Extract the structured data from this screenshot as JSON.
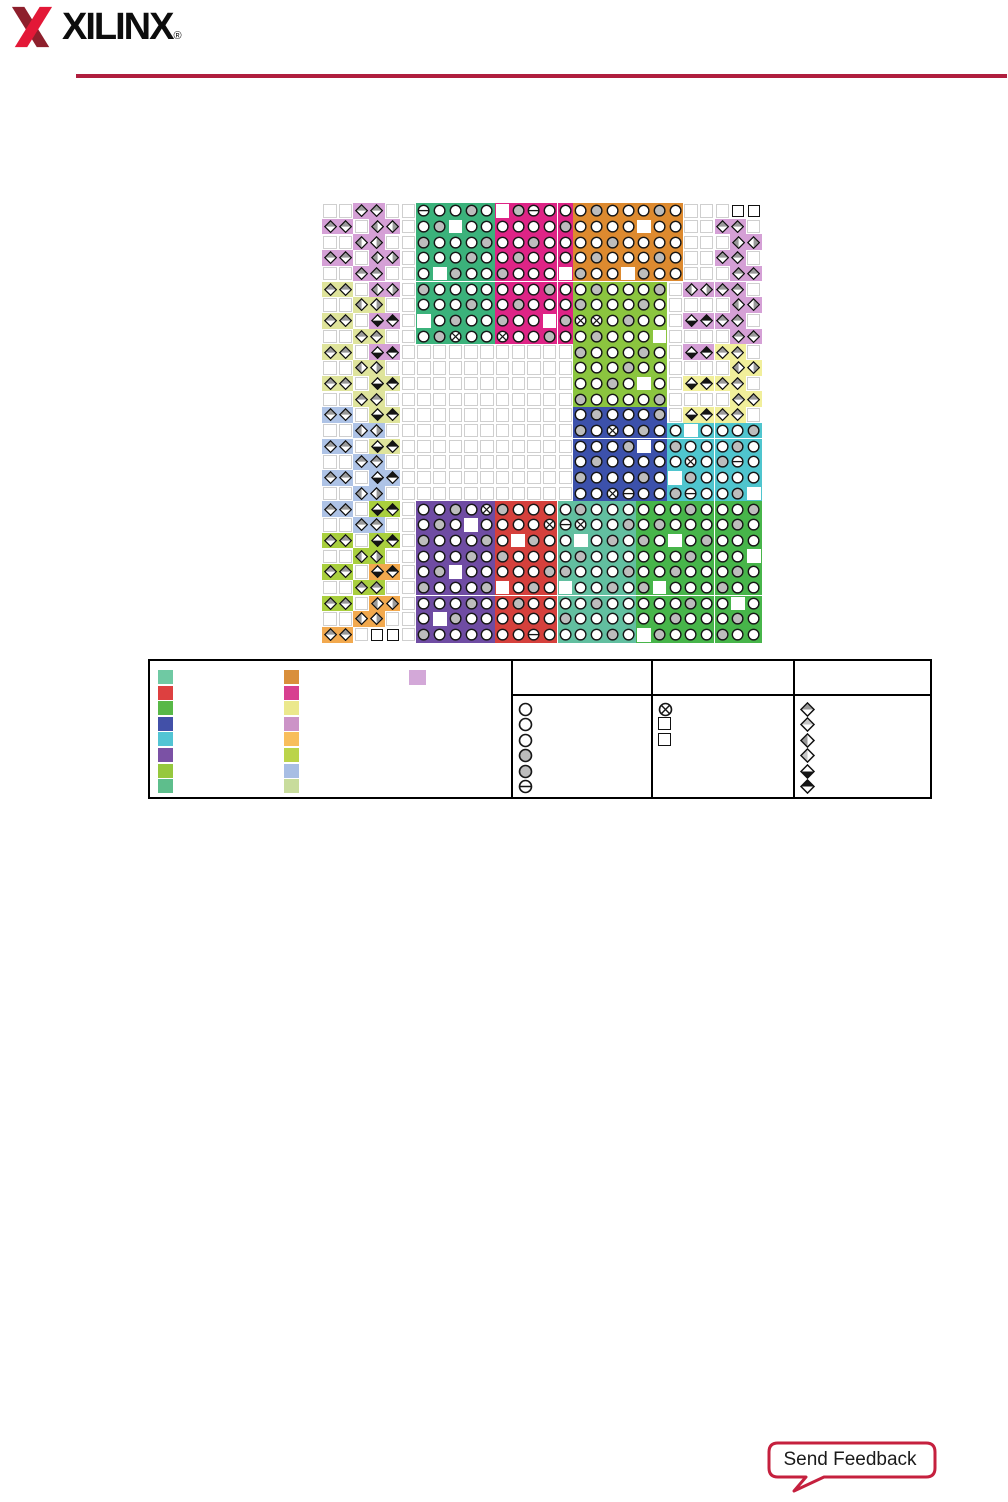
{
  "header": {
    "logo_text": "XILINX",
    "logo_reg": "®",
    "rule_color": "#B01E3E",
    "logo_dark_red": "#8E1F2C",
    "logo_bright_red": "#E31837"
  },
  "diagram": {
    "grid": {
      "cols": 28,
      "rows": 28,
      "cell": 15.7,
      "left": 322,
      "top": 203
    },
    "colors": {
      "green1": "#3BB27B",
      "magenta": "#DE2486",
      "orange": "#DD8A2F",
      "lime": "#8BC53F",
      "navy": "#3C51AB",
      "cyan": "#4FC5CE",
      "purple": "#6F4CA3",
      "red": "#D5403C",
      "seagreen": "#62BFA0",
      "green2": "#47B54A",
      "plum": "#D5A0D6",
      "khaki": "#DFE49C",
      "lblue": "#AEC3E6",
      "gyellow": "#A9CF3E",
      "orangeB": "#F2A94E",
      "yellowR": "#F1EF9B",
      "ball_gray": "#BDBDBD",
      "ball_stroke": "#161616",
      "diamond_dark": "#9A9A9A",
      "diamond_light": "#C6C6C6",
      "diamond_black": "#151515",
      "empty_border": "#CFCFCF"
    },
    "regions": [
      [
        "bank-green-top",
        6,
        0,
        5,
        9,
        "green1",
        1
      ],
      [
        "bank-magenta",
        11,
        0,
        5,
        9,
        "magenta",
        5
      ],
      [
        "bank-orange",
        16,
        0,
        7,
        5,
        "orange",
        3
      ],
      [
        "bank-lime",
        16,
        5,
        6,
        8,
        "lime",
        8
      ],
      [
        "bank-navy",
        16,
        13,
        6,
        6,
        "navy",
        2
      ],
      [
        "bank-cyan",
        22,
        14,
        6,
        5,
        "cyan",
        6
      ],
      [
        "bank-purple",
        6,
        19,
        5,
        9,
        "purple",
        4
      ],
      [
        "bank-red",
        11,
        19,
        4,
        9,
        "red",
        9
      ],
      [
        "bank-seagreen",
        15,
        19,
        5,
        9,
        "seagreen",
        7
      ],
      [
        "bank-green-bottom",
        20,
        19,
        8,
        9,
        "green2",
        0
      ]
    ],
    "border_pairs": [
      [
        0,
        2,
        "plum",
        "H"
      ],
      [
        2,
        2,
        "plum",
        "V"
      ],
      [
        4,
        2,
        "plum",
        "H"
      ],
      [
        6,
        2,
        "khaki",
        "V"
      ],
      [
        8,
        2,
        "khaki",
        "H"
      ],
      [
        10,
        2,
        "khaki",
        "V"
      ],
      [
        12,
        2,
        "khaki",
        "H"
      ],
      [
        14,
        2,
        "lblue",
        "V"
      ],
      [
        16,
        2,
        "lblue",
        "H"
      ],
      [
        18,
        2,
        "lblue",
        "V"
      ],
      [
        20,
        2,
        "lblue",
        "H"
      ],
      [
        22,
        2,
        "gyellow",
        "V"
      ],
      [
        24,
        2,
        "gyellow",
        "H"
      ],
      [
        26,
        2,
        "orangeB",
        "V"
      ],
      [
        1,
        0,
        "plum",
        "H"
      ],
      [
        3,
        0,
        "plum",
        "H"
      ],
      [
        5,
        0,
        "khaki",
        "H"
      ],
      [
        7,
        0,
        "khaki",
        "H"
      ],
      [
        9,
        0,
        "khaki",
        "H"
      ],
      [
        11,
        0,
        "khaki",
        "H"
      ],
      [
        13,
        0,
        "lblue",
        "H"
      ],
      [
        15,
        0,
        "lblue",
        "H"
      ],
      [
        17,
        0,
        "lblue",
        "H"
      ],
      [
        19,
        0,
        "lblue",
        "H"
      ],
      [
        21,
        0,
        "gyellow",
        "H"
      ],
      [
        23,
        0,
        "gyellow",
        "H"
      ],
      [
        25,
        0,
        "gyellow",
        "H"
      ],
      [
        27,
        0,
        "orangeB",
        "H"
      ],
      [
        1,
        3,
        "plum",
        "V"
      ],
      [
        3,
        3,
        "plum",
        "V"
      ],
      [
        5,
        3,
        "plum",
        "V"
      ],
      [
        7,
        3,
        "plum",
        "B"
      ],
      [
        9,
        3,
        "plum",
        "B"
      ],
      [
        11,
        3,
        "khaki",
        "B"
      ],
      [
        13,
        3,
        "khaki",
        "B"
      ],
      [
        15,
        3,
        "khaki",
        "B"
      ],
      [
        17,
        3,
        "lblue",
        "B"
      ],
      [
        19,
        3,
        "gyellow",
        "B"
      ],
      [
        21,
        3,
        "gyellow",
        "B"
      ],
      [
        23,
        3,
        "orangeB",
        "B"
      ],
      [
        25,
        3,
        "orangeB",
        "V"
      ],
      [
        2,
        26,
        "plum",
        "V"
      ],
      [
        4,
        26,
        "plum",
        "H"
      ],
      [
        6,
        26,
        "plum",
        "V"
      ],
      [
        8,
        26,
        "plum",
        "H"
      ],
      [
        10,
        26,
        "yellowR",
        "V"
      ],
      [
        12,
        26,
        "yellowR",
        "H"
      ],
      [
        1,
        25,
        "plum",
        "H"
      ],
      [
        3,
        25,
        "plum",
        "H"
      ],
      [
        5,
        25,
        "plum",
        "H"
      ],
      [
        7,
        25,
        "plum",
        "H"
      ],
      [
        9,
        25,
        "yellowR",
        "H"
      ],
      [
        11,
        25,
        "yellowR",
        "H"
      ],
      [
        13,
        25,
        "yellowR",
        "H"
      ],
      [
        5,
        23,
        "plum",
        "V"
      ],
      [
        7,
        23,
        "plum",
        "B"
      ],
      [
        9,
        23,
        "plum",
        "B"
      ],
      [
        11,
        23,
        "yellowR",
        "B"
      ],
      [
        13,
        23,
        "yellowR",
        "B"
      ]
    ],
    "specials": [
      [
        6,
        0,
        "h"
      ],
      [
        13,
        0,
        "h"
      ],
      [
        8,
        8,
        "x"
      ],
      [
        11,
        8,
        "x"
      ],
      [
        16,
        7,
        "x"
      ],
      [
        17,
        7,
        "x"
      ],
      [
        18,
        14,
        "x"
      ],
      [
        23,
        16,
        "x"
      ],
      [
        26,
        16,
        "h"
      ],
      [
        18,
        18,
        "x"
      ],
      [
        19,
        18,
        "h"
      ],
      [
        23,
        18,
        "h"
      ],
      [
        10,
        19,
        "x"
      ],
      [
        14,
        20,
        "x"
      ],
      [
        15,
        20,
        "h"
      ],
      [
        16,
        20,
        "x"
      ],
      [
        13,
        27,
        "h"
      ]
    ],
    "corner_squares": [
      [
        26,
        0
      ],
      [
        27,
        0
      ],
      [
        3,
        27
      ],
      [
        4,
        27
      ]
    ],
    "pattern": {
      "gray_mod": 13,
      "gray_lt": 3,
      "blank_mod": 16,
      "blank_eq": 1
    }
  },
  "legend": {
    "chips_col1": [
      "#6FC9A3",
      "#DD4040",
      "#58B847",
      "#4250A8",
      "#52C4D4",
      "#7B51A5",
      "#96C83E",
      "#5EBE8C"
    ],
    "chips_col2": [
      "#D98F3B",
      "#D84090",
      "#EBE88D",
      "#CC93C7",
      "#F8BE5C",
      "#BBD44A",
      "#A8BEE4",
      "#C8DC9C"
    ],
    "single_chip": "#D3A8D8",
    "circle_symbols": [
      "o",
      "o",
      "o",
      "g",
      "g",
      "h"
    ],
    "mark_symbols": [
      "x",
      "sq",
      "sq"
    ],
    "diamond_symbols": [
      "top-dark",
      "top-light",
      "left-dark",
      "left-light",
      "bottom-black",
      "top-black"
    ]
  },
  "feedback": {
    "label": "Send Feedback",
    "border_color": "#C5203E"
  }
}
